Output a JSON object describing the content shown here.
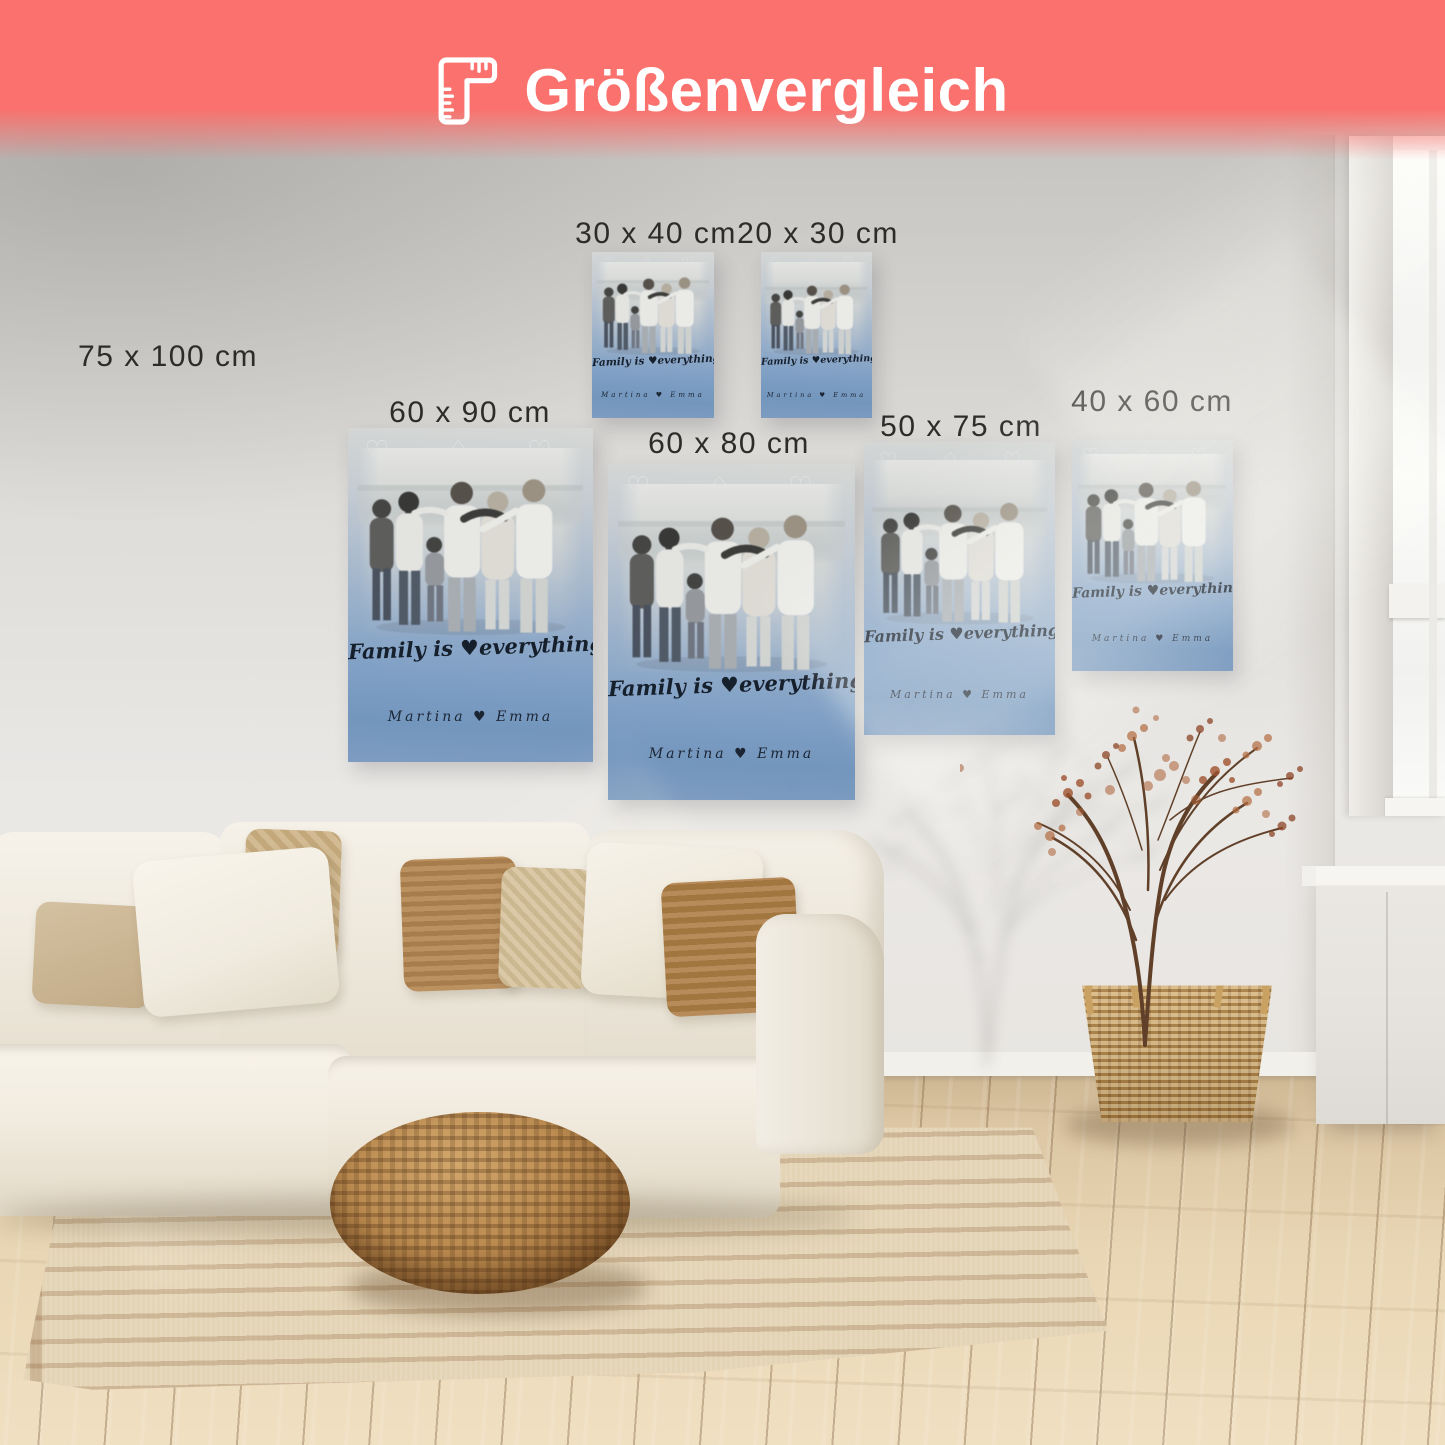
{
  "header": {
    "title": "Größenvergleich",
    "icon": "folding-ruler-icon",
    "background_color": "#FA716D",
    "text_color": "#FFFFFF"
  },
  "poster_design": {
    "headline": "Family is ♥everything ♡.",
    "names": "Martina ♥ Emma",
    "photo": "family-of-six-from-behind-on-beach-black-and-white",
    "top_color": "#D6D8D5",
    "bottom_color": "#7396BD",
    "text_color": "#161F2C"
  },
  "sizes": [
    {
      "id": "s75x100",
      "label": "75 x 100 cm",
      "has_poster": false
    },
    {
      "id": "s30x40",
      "label": "30 x 40 cm",
      "has_poster": true
    },
    {
      "id": "s20x30",
      "label": "20 x 30 cm",
      "has_poster": true
    },
    {
      "id": "s60x90",
      "label": "60 x 90 cm",
      "has_poster": true
    },
    {
      "id": "s60x80",
      "label": "60 x 80 cm",
      "has_poster": true
    },
    {
      "id": "s50x75",
      "label": "50 x 75 cm",
      "has_poster": true
    },
    {
      "id": "s40x60",
      "label": "40 x 60 cm",
      "has_poster": true
    }
  ],
  "scene": {
    "description": "living-room-with-cream-sofa-rattan-pouf-jute-rug-dried-plant-in-basket-and-tall-window"
  }
}
